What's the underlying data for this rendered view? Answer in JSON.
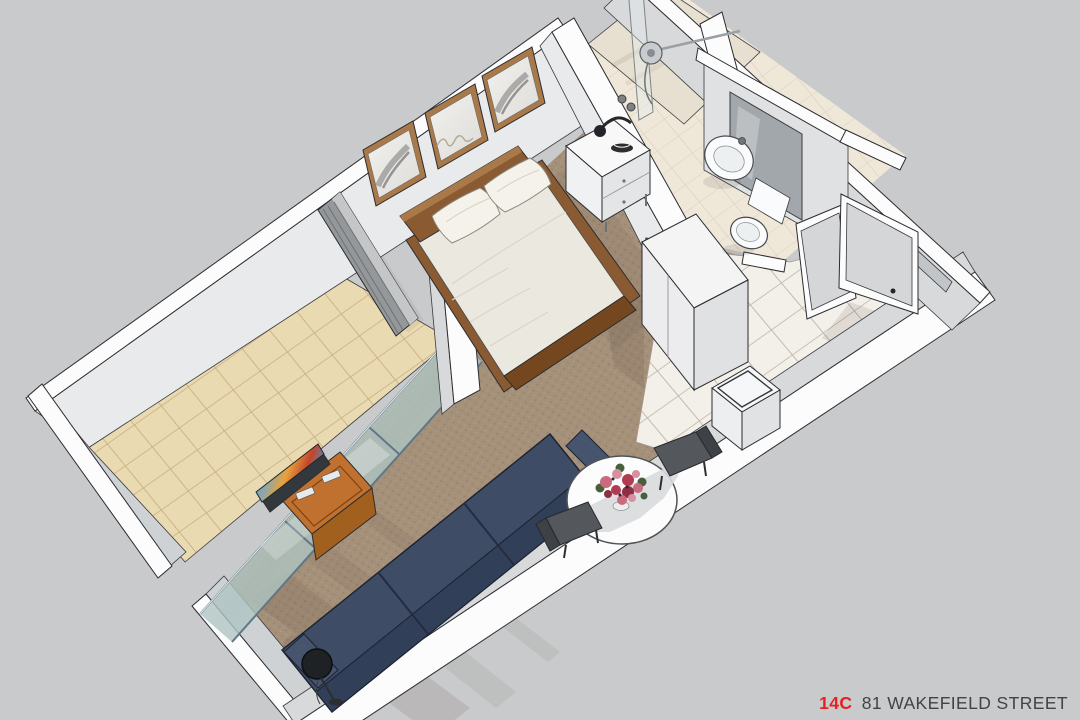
{
  "footer": {
    "unit": "14C",
    "address": "81 WAKEFIELD STREET",
    "unit_color": "#e8201e",
    "address_color": "#3f4446"
  },
  "colors": {
    "background": "#c9cacb",
    "wall_white": "#fcfcfd",
    "wall_face": "#d7d9db",
    "wall_face_light": "#e9eaec",
    "wall_face_dark": "#cfd2d4",
    "opening_dark": "#c2c5c7",
    "door_panel": "#d4d6d8",
    "carpet": "#a5907a",
    "carpet_dot": "#93806b",
    "carpet_dot2": "#b09a83",
    "balcony_tile": "#e9dab1",
    "balcony_grout": "#c6ad82",
    "bath_tile": "#efe8d9",
    "bath_grout": "#d8d0c1",
    "shower_tile": "#e7e0d1",
    "entry_tile": "#f3f0e9",
    "entry_grout": "#b9b2a6",
    "glass_frame": "#5f7887",
    "louver": "#95989a",
    "louver_top": "#c4c6c8",
    "wood": "#8a5a33",
    "wood_dark": "#74471f",
    "wood_light": "#a9794a",
    "bedding": "#ebe8df",
    "pillow": "#f4f2ea",
    "tv_wood": "#c0702f",
    "tv_wood_dark": "#a2601f",
    "tv_dark": "#33383d",
    "sofa": "#3e4c66",
    "sofa_dark": "#323f58",
    "sofa_light": "#46546e",
    "table": "#fcfcfc",
    "table_shade": "#d9dadc",
    "chair": "#54585d",
    "chair_dark": "#3e4246",
    "lamp": "#1f2225",
    "mirror": "#a2a7ab",
    "fixture": "#fafbfc",
    "fixture_inner": "#edf0f1",
    "metal": "#c9cccf",
    "flower_pink": "#d890a0",
    "flower_rose": "#c96a7e",
    "flower_red": "#b23b52",
    "flower_deep": "#8e2f44",
    "leaf": "#45603b",
    "closet_top": "#f4f4f5",
    "closet_front": "#ececee",
    "closet_side": "#dfe1e3",
    "appliance_top": "#f6f7f8",
    "appliance_front": "#eceef0",
    "appliance_side": "#e0e2e4"
  }
}
